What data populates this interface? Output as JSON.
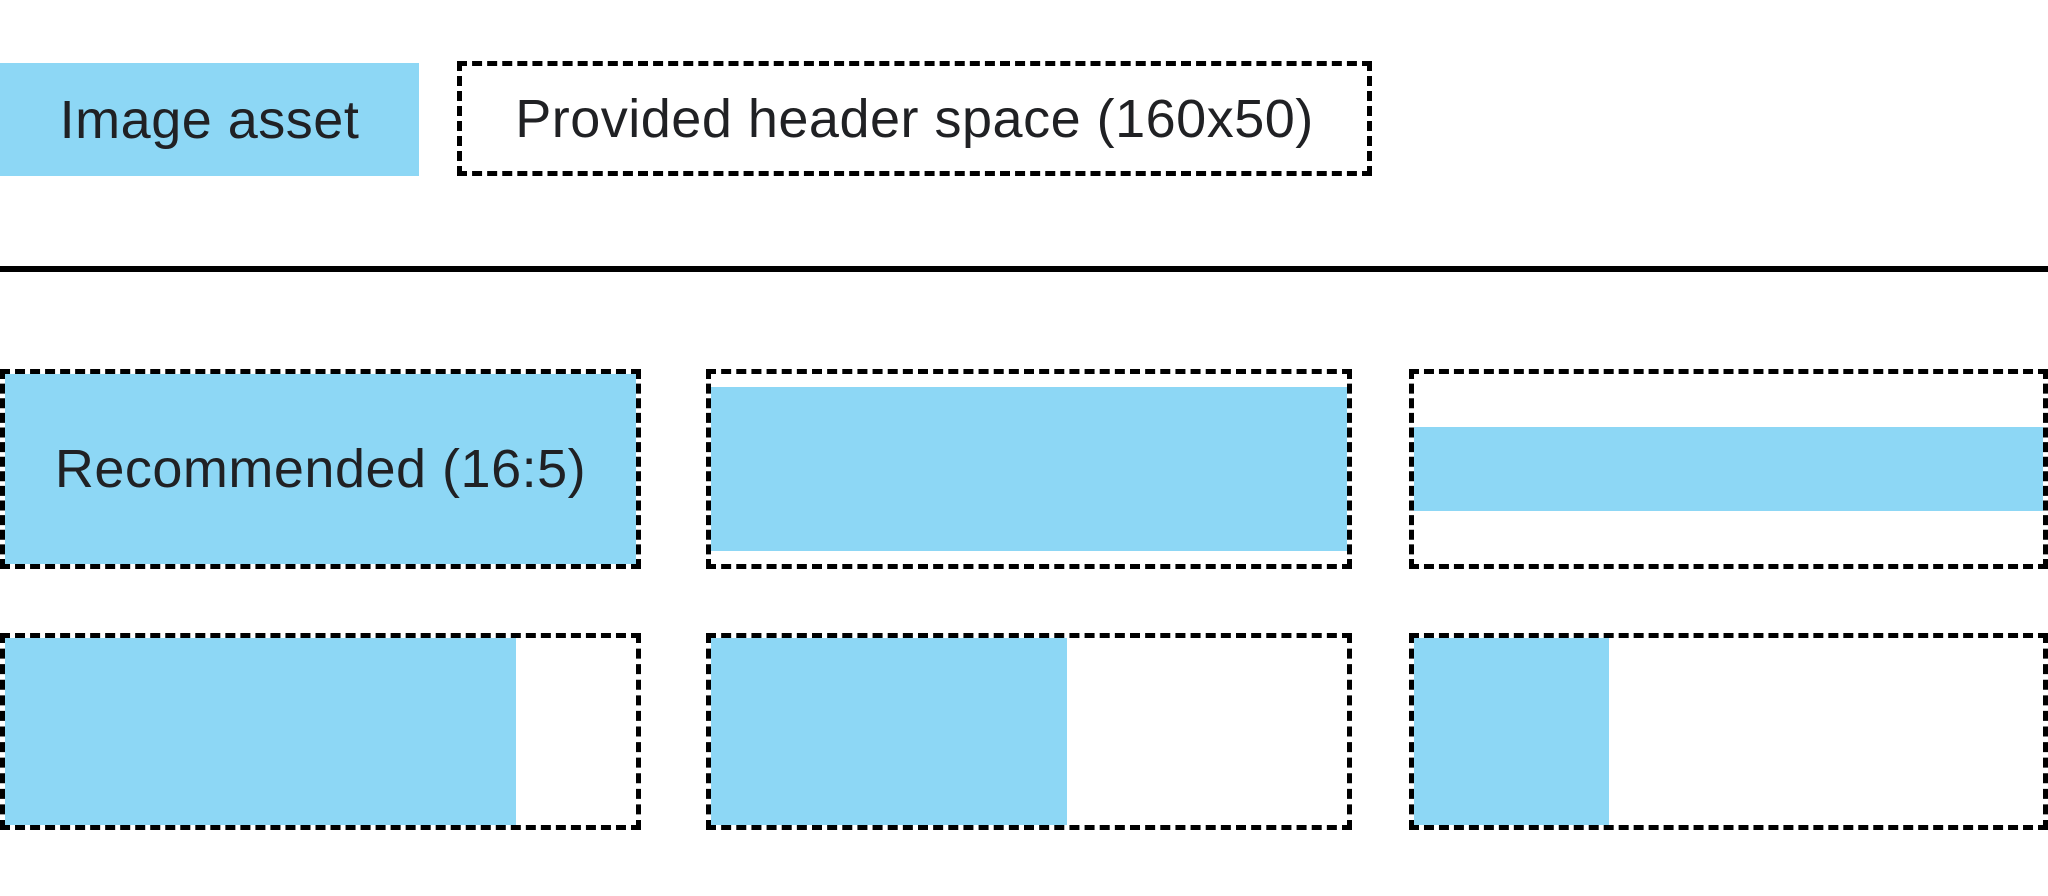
{
  "colors": {
    "image_asset_blue": "#8DD7F5",
    "line_black": "#000000",
    "text": "#202124",
    "background": "#FFFFFF"
  },
  "legend": {
    "image_asset_label": "Image asset",
    "header_space_label": "Provided header space (160x50)"
  },
  "examples": [
    {
      "name": "recommended-16-5",
      "label": "Recommended (16:5)",
      "fill": {
        "width_pct": 100,
        "height_pct": 100
      }
    },
    {
      "name": "full-width-letterboxed",
      "label": "",
      "fill": {
        "width_pct": 100,
        "height_pct": 86
      }
    },
    {
      "name": "full-width-thin-banner",
      "label": "",
      "fill": {
        "width_pct": 100,
        "height_pct": 44
      }
    },
    {
      "name": "full-height-wide-asset",
      "label": "",
      "fill": {
        "width_pct": 81,
        "height_pct": 100
      }
    },
    {
      "name": "full-height-medium-asset",
      "label": "",
      "fill": {
        "width_pct": 56,
        "height_pct": 100
      }
    },
    {
      "name": "full-height-narrow-asset",
      "label": "",
      "fill": {
        "width_pct": 31,
        "height_pct": 100
      }
    }
  ]
}
